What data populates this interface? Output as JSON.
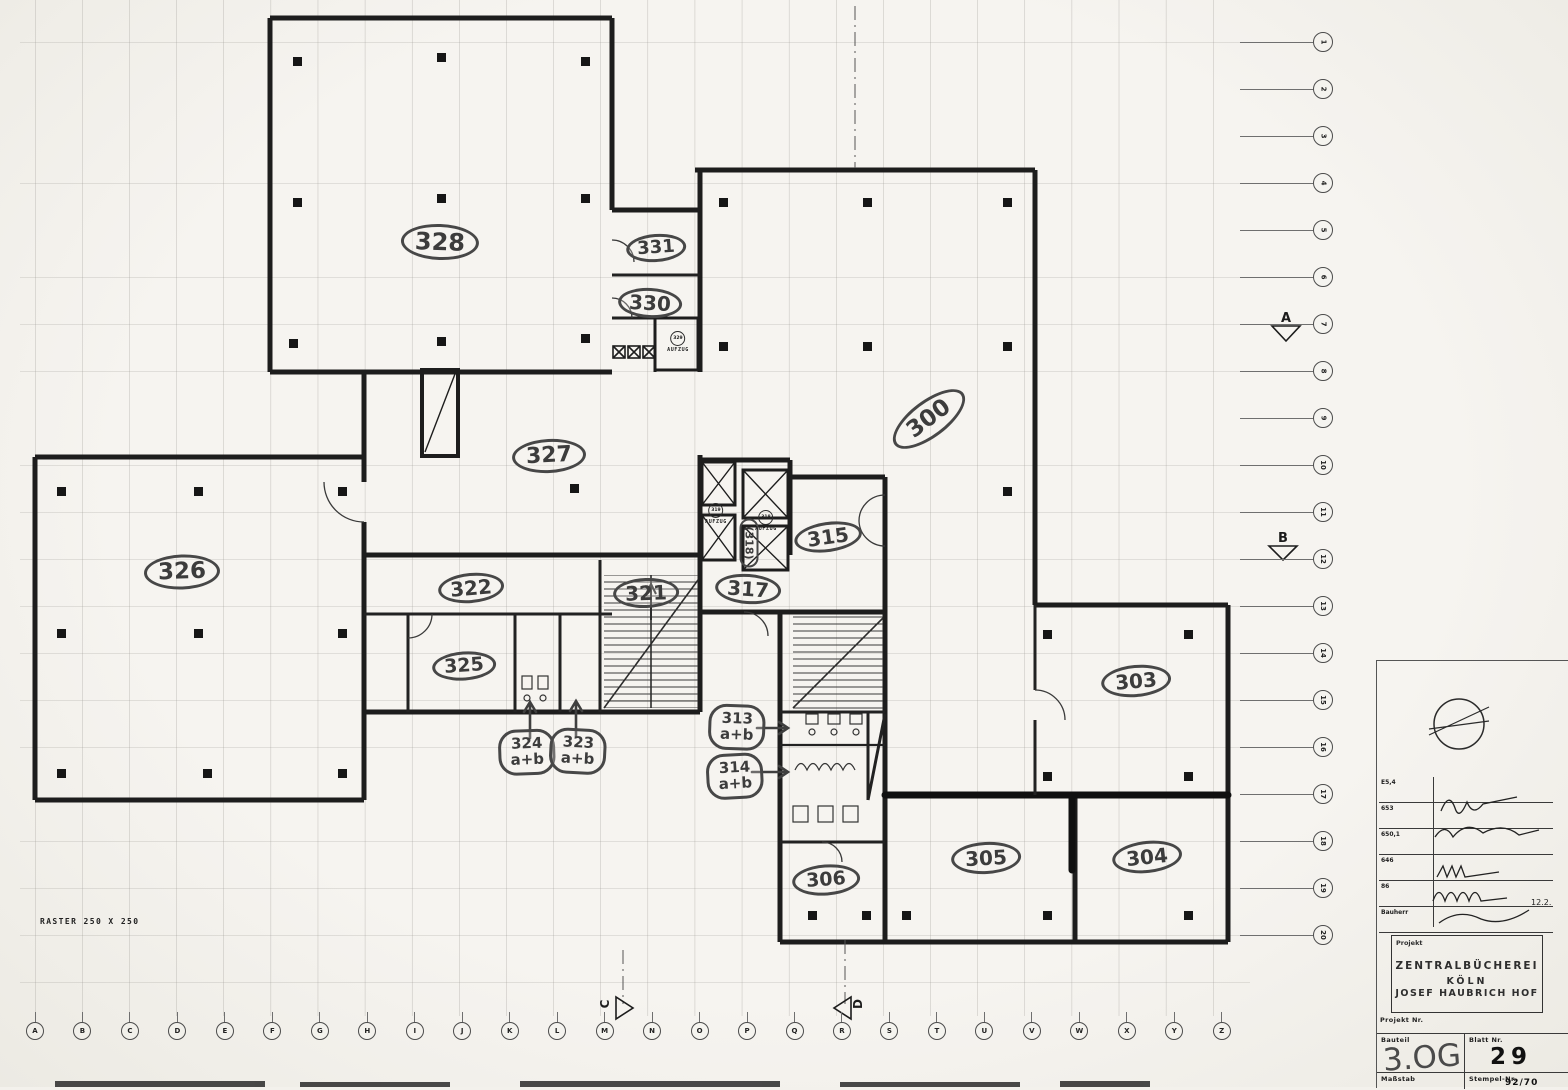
{
  "drawing": {
    "raster_note": "RASTER 250 X 250",
    "rooms": {
      "r300": "300",
      "r303": "303",
      "r304": "304",
      "r305": "305",
      "r306": "306",
      "r313": "313",
      "r314": "314",
      "r315": "315",
      "r317": "317",
      "r321": "321",
      "r322": "322",
      "r323": "323",
      "r324": "324",
      "r325": "325",
      "r326": "326",
      "r327": "327",
      "r328": "328",
      "r330": "330",
      "r331": "331",
      "ab": "a+b",
      "lobby318": "(318)"
    },
    "elevators": {
      "label": "AUFZUG",
      "e329": "329",
      "e319": "319",
      "e318": "318"
    }
  },
  "grid": {
    "letters": [
      "A",
      "B",
      "C",
      "D",
      "E",
      "F",
      "G",
      "H",
      "I",
      "J",
      "K",
      "L",
      "M",
      "N",
      "O",
      "P",
      "Q",
      "R",
      "S",
      "T",
      "U",
      "V",
      "W",
      "X",
      "Y",
      "Z"
    ],
    "numbers": [
      "1",
      "2",
      "3",
      "4",
      "5",
      "6",
      "7",
      "8",
      "9",
      "10",
      "11",
      "12",
      "13",
      "14",
      "15",
      "16",
      "17",
      "18",
      "19",
      "20"
    ],
    "sections": {
      "a": "A",
      "b": "B",
      "c": "C",
      "d": "D"
    }
  },
  "title_block": {
    "projekt_label": "Projekt",
    "project_line1": "ZENTRALBÜCHEREI",
    "project_line2": "KÖLN",
    "project_line3": "JOSEF HAUBRICH HOF",
    "projekt_nr_label": "Projekt Nr.",
    "sign_rows": [
      "E5,4",
      "653",
      "650,1",
      "646",
      "86",
      "Bauherr"
    ],
    "sign_date": "12.2.",
    "bauteil_label": "Bauteil",
    "bauteil_value": "3.OG",
    "blatt_label": "Blatt Nr.",
    "blatt_value": "29",
    "massstab_label": "Maßstab",
    "stempel_label": "Stempel-Nr.",
    "stempel_value": "92/70"
  }
}
